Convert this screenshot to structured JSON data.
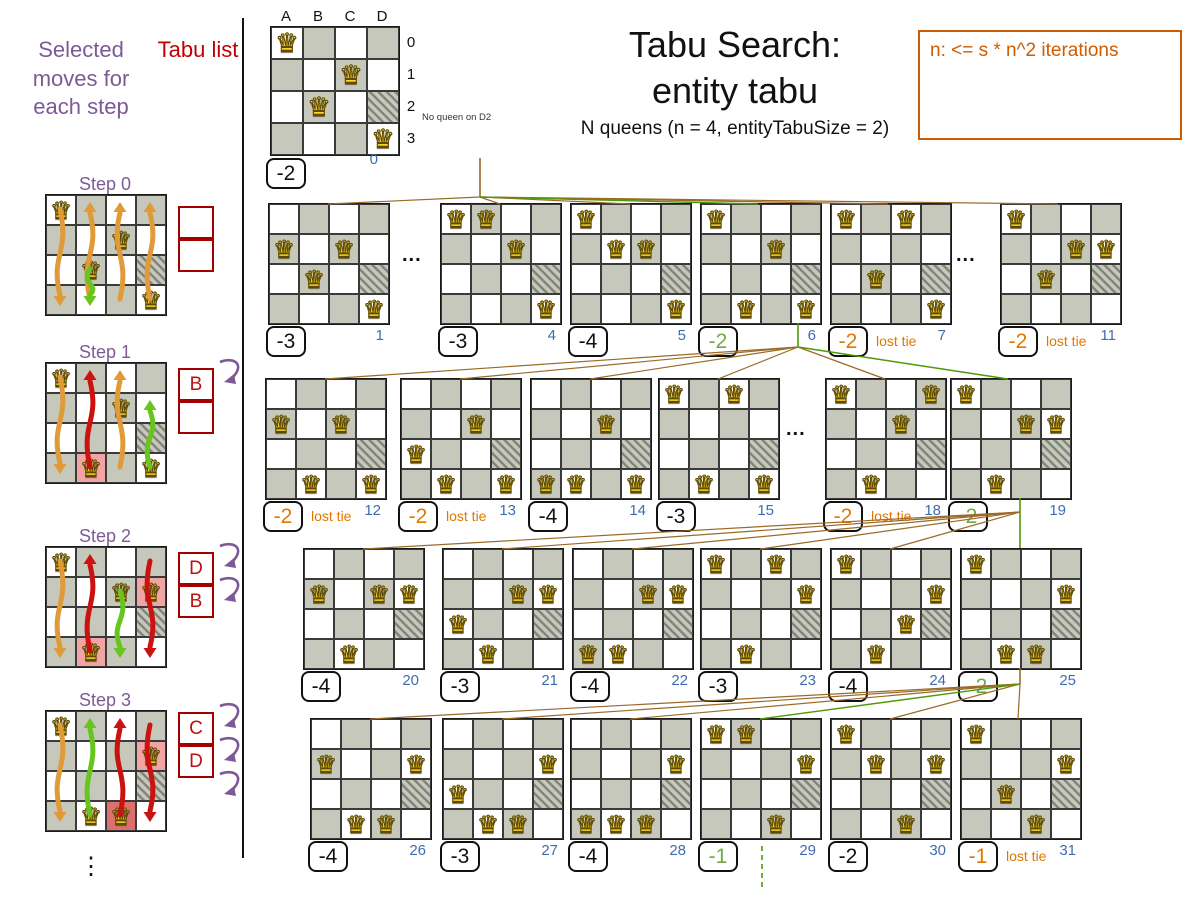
{
  "title": {
    "line1": "Tabu Search:",
    "line2": "entity tabu",
    "subtitle": "N queens (n = 4, entityTabuSize = 2)"
  },
  "note": {
    "text": "n: <= s * n^2 iterations"
  },
  "left_panel": {
    "moves_header": "Selected moves for each step",
    "tabu_header": "Tabu list",
    "vertical_ellipsis": "⋮",
    "steps": [
      {
        "label": "Step 0",
        "tabu": [
          "",
          ""
        ],
        "tabu_arrow_count": 0,
        "queens": [
          [
            0,
            0
          ],
          [
            2,
            1
          ],
          [
            1,
            2
          ],
          [
            3,
            3
          ]
        ],
        "highlights": [],
        "arrows": [
          {
            "col": 0,
            "from": 0,
            "to": 3,
            "color": "orange"
          },
          {
            "col": 1,
            "from": 3,
            "to": 0,
            "color": "orange"
          },
          {
            "col": 2,
            "from": 3,
            "to": 0,
            "color": "orange"
          },
          {
            "col": 3,
            "from": 3,
            "to": 0,
            "color": "orange"
          },
          {
            "col": 1,
            "from": 2,
            "to": 3,
            "color": "green"
          }
        ]
      },
      {
        "label": "Step 1",
        "tabu": [
          "B",
          ""
        ],
        "tabu_arrow_count": 1,
        "queens": [
          [
            0,
            0
          ],
          [
            2,
            1
          ],
          [
            1,
            3
          ],
          [
            3,
            3
          ]
        ],
        "highlights": [
          [
            1,
            3,
            "pink"
          ]
        ],
        "arrows": [
          {
            "col": 0,
            "from": 0,
            "to": 3,
            "color": "orange"
          },
          {
            "col": 1,
            "from": 3,
            "to": 0,
            "color": "red"
          },
          {
            "col": 2,
            "from": 3,
            "to": 0,
            "color": "orange"
          },
          {
            "col": 3,
            "from": 3,
            "to": 1,
            "color": "green"
          }
        ]
      },
      {
        "label": "Step 2",
        "tabu": [
          "D",
          "B"
        ],
        "tabu_arrow_count": 2,
        "queens": [
          [
            0,
            0
          ],
          [
            2,
            1
          ],
          [
            3,
            1
          ],
          [
            1,
            3
          ]
        ],
        "highlights": [
          [
            3,
            1,
            "pink"
          ],
          [
            1,
            3,
            "pink"
          ]
        ],
        "arrows": [
          {
            "col": 0,
            "from": 0,
            "to": 3,
            "color": "orange"
          },
          {
            "col": 1,
            "from": 3,
            "to": 0,
            "color": "red"
          },
          {
            "col": 2,
            "from": 1,
            "to": 3,
            "color": "green"
          },
          {
            "col": 3,
            "from": 0,
            "to": 3,
            "color": "red"
          }
        ]
      },
      {
        "label": "Step 3",
        "tabu": [
          "C",
          "D"
        ],
        "tabu_arrow_count": 3,
        "queens": [
          [
            0,
            0
          ],
          [
            3,
            1
          ],
          [
            1,
            3
          ],
          [
            2,
            3
          ]
        ],
        "highlights": [
          [
            3,
            1,
            "pink"
          ],
          [
            2,
            3,
            "red"
          ]
        ],
        "arrows": [
          {
            "col": 0,
            "from": 0,
            "to": 3,
            "color": "orange"
          },
          {
            "col": 1,
            "from": 3,
            "to": 0,
            "color": "green"
          },
          {
            "col": 2,
            "from": 3,
            "to": 0,
            "color": "red"
          },
          {
            "col": 3,
            "from": 0,
            "to": 3,
            "color": "red"
          }
        ]
      }
    ]
  },
  "root": {
    "columns": [
      "A",
      "B",
      "C",
      "D"
    ],
    "row_labels": [
      "0",
      "1",
      "2",
      "3"
    ],
    "queens": [
      [
        0,
        0
      ],
      [
        2,
        1
      ],
      [
        1,
        2
      ],
      [
        3,
        3
      ]
    ],
    "annotation": "No queen on D2",
    "score": "-2",
    "index": "0"
  },
  "tree": {
    "lost_tie_label": "lost tie",
    "ellipsis": "...",
    "boards": [
      {
        "id": "1",
        "score": "-3",
        "status": "normal",
        "index": "1",
        "queens": [
          [
            0,
            1
          ],
          [
            2,
            1
          ],
          [
            1,
            2
          ],
          [
            3,
            3
          ]
        ]
      },
      {
        "id": "4",
        "score": "-3",
        "status": "normal",
        "index": "4",
        "queens": [
          [
            0,
            0
          ],
          [
            1,
            0
          ],
          [
            2,
            1
          ],
          [
            3,
            3
          ]
        ]
      },
      {
        "id": "5",
        "score": "-4",
        "status": "normal",
        "index": "5",
        "queens": [
          [
            0,
            0
          ],
          [
            1,
            1
          ],
          [
            2,
            1
          ],
          [
            3,
            3
          ]
        ]
      },
      {
        "id": "6",
        "score": "-2",
        "status": "selected",
        "index": "6",
        "queens": [
          [
            0,
            0
          ],
          [
            2,
            1
          ],
          [
            1,
            3
          ],
          [
            3,
            3
          ]
        ]
      },
      {
        "id": "7",
        "score": "-2",
        "status": "tie",
        "index": "7",
        "queens": [
          [
            0,
            0
          ],
          [
            2,
            0
          ],
          [
            1,
            2
          ],
          [
            3,
            3
          ]
        ]
      },
      {
        "id": "11",
        "score": "-2",
        "status": "tie",
        "index": "11",
        "queens": [
          [
            0,
            0
          ],
          [
            2,
            1
          ],
          [
            3,
            1
          ],
          [
            1,
            2
          ]
        ]
      },
      {
        "id": "12",
        "score": "-2",
        "status": "tie",
        "index": "12",
        "queens": [
          [
            0,
            1
          ],
          [
            2,
            1
          ],
          [
            1,
            3
          ],
          [
            3,
            3
          ]
        ]
      },
      {
        "id": "13",
        "score": "-2",
        "status": "tie",
        "index": "13",
        "queens": [
          [
            2,
            1
          ],
          [
            0,
            2
          ],
          [
            1,
            3
          ],
          [
            3,
            3
          ]
        ]
      },
      {
        "id": "14",
        "score": "-4",
        "status": "normal",
        "index": "14",
        "queens": [
          [
            2,
            1
          ],
          [
            0,
            3
          ],
          [
            1,
            3
          ],
          [
            3,
            3
          ]
        ]
      },
      {
        "id": "15",
        "score": "-3",
        "status": "normal",
        "index": "15",
        "queens": [
          [
            0,
            0
          ],
          [
            2,
            0
          ],
          [
            1,
            3
          ],
          [
            3,
            3
          ]
        ]
      },
      {
        "id": "18",
        "score": "-2",
        "status": "tie",
        "index": "18",
        "queens": [
          [
            0,
            0
          ],
          [
            3,
            0
          ],
          [
            2,
            1
          ],
          [
            1,
            3
          ]
        ]
      },
      {
        "id": "19",
        "score": "-2",
        "status": "selected",
        "index": "19",
        "queens": [
          [
            0,
            0
          ],
          [
            2,
            1
          ],
          [
            3,
            1
          ],
          [
            1,
            3
          ]
        ]
      },
      {
        "id": "20",
        "score": "-4",
        "status": "normal",
        "index": "20",
        "queens": [
          [
            0,
            1
          ],
          [
            2,
            1
          ],
          [
            3,
            1
          ],
          [
            1,
            3
          ]
        ]
      },
      {
        "id": "21",
        "score": "-3",
        "status": "normal",
        "index": "21",
        "queens": [
          [
            2,
            1
          ],
          [
            3,
            1
          ],
          [
            0,
            2
          ],
          [
            1,
            3
          ]
        ]
      },
      {
        "id": "22",
        "score": "-4",
        "status": "normal",
        "index": "22",
        "queens": [
          [
            2,
            1
          ],
          [
            3,
            1
          ],
          [
            0,
            3
          ],
          [
            1,
            3
          ]
        ]
      },
      {
        "id": "23",
        "score": "-3",
        "status": "normal",
        "index": "23",
        "queens": [
          [
            0,
            0
          ],
          [
            2,
            0
          ],
          [
            3,
            1
          ],
          [
            1,
            3
          ]
        ]
      },
      {
        "id": "24",
        "score": "-4",
        "status": "normal",
        "index": "24",
        "queens": [
          [
            0,
            0
          ],
          [
            3,
            1
          ],
          [
            2,
            2
          ],
          [
            1,
            3
          ]
        ]
      },
      {
        "id": "25",
        "score": "-2",
        "status": "selected",
        "index": "25",
        "queens": [
          [
            0,
            0
          ],
          [
            3,
            1
          ],
          [
            1,
            3
          ],
          [
            2,
            3
          ]
        ]
      },
      {
        "id": "26",
        "score": "-4",
        "status": "normal",
        "index": "26",
        "queens": [
          [
            0,
            1
          ],
          [
            3,
            1
          ],
          [
            1,
            3
          ],
          [
            2,
            3
          ]
        ]
      },
      {
        "id": "27",
        "score": "-3",
        "status": "normal",
        "index": "27",
        "queens": [
          [
            3,
            1
          ],
          [
            0,
            2
          ],
          [
            1,
            3
          ],
          [
            2,
            3
          ]
        ]
      },
      {
        "id": "28",
        "score": "-4",
        "status": "normal",
        "index": "28",
        "queens": [
          [
            3,
            1
          ],
          [
            0,
            3
          ],
          [
            1,
            3
          ],
          [
            2,
            3
          ]
        ]
      },
      {
        "id": "29",
        "score": "-1",
        "status": "selected",
        "index": "29",
        "queens": [
          [
            0,
            0
          ],
          [
            1,
            0
          ],
          [
            3,
            1
          ],
          [
            2,
            3
          ]
        ]
      },
      {
        "id": "30",
        "score": "-2",
        "status": "normal",
        "index": "30",
        "queens": [
          [
            0,
            0
          ],
          [
            1,
            1
          ],
          [
            3,
            1
          ],
          [
            2,
            3
          ]
        ]
      },
      {
        "id": "31",
        "score": "-1",
        "status": "tie",
        "index": "31",
        "queens": [
          [
            0,
            0
          ],
          [
            3,
            1
          ],
          [
            1,
            2
          ],
          [
            2,
            3
          ]
        ]
      }
    ]
  },
  "icons": {
    "queen": "♛"
  },
  "colors": {
    "purple": "#7d5a96",
    "tabu_red": "#bb1111",
    "tabu_border": "#a40000",
    "score_normal": "#111111",
    "score_green": "#73a940",
    "score_orange": "#e07800",
    "index_blue": "#3f6bb0",
    "line_brown": "#9a6a28",
    "line_green": "#4e9a06",
    "note_orange": "#ce5c00",
    "arrow_orange": "#e19a38",
    "arrow_red": "#cc1111",
    "arrow_green": "#68c51e",
    "cell_gray": "#c6c8bc",
    "hl_pink": "#f2a3a3",
    "hl_red": "#dd6f6f"
  }
}
